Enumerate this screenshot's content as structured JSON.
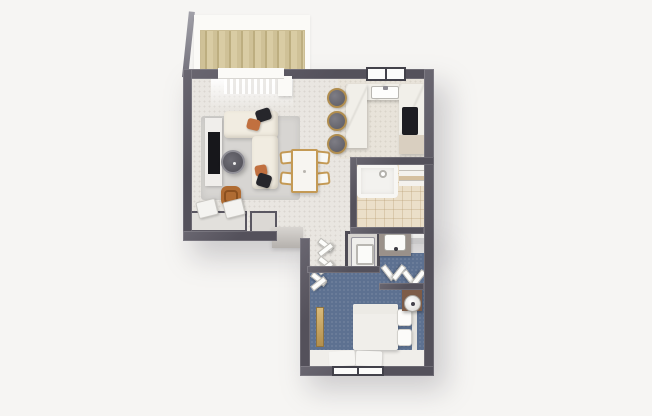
{
  "scene": {
    "kind": "3d-rendered-floor-plan",
    "view": "top-down",
    "text_labels": []
  },
  "palette": {
    "bg": "#f6f5f3",
    "wall": "#54515b",
    "white": "#fbfaf7",
    "floor_main": "#e9e6e1",
    "floor_kitchen": "#e8e3da",
    "tile": "#ebdfc9",
    "carpet_blue": "#5d7191",
    "rug_gray": "#d7d5d2",
    "sofa_cream": "#f1ece1",
    "pillow_black": "#26262b",
    "pillow_terracotta": "#c1703f",
    "chair_cognac": "#b06c33",
    "gold": "#c49a55",
    "tv_black": "#17171b",
    "marble": "#f1efe9",
    "cooktop_black": "#1d1d22",
    "cabinet_beige": "#d9cfc0",
    "nightstand_brown": "#7d5c48",
    "bed_white": "#f0eeea",
    "appliance_white": "#f0efec",
    "vanity_gray": "#9a918a"
  },
  "rooms": [
    {
      "id": "balcony",
      "name": "Balcony with wood deck"
    },
    {
      "id": "living-room",
      "name": "Living room"
    },
    {
      "id": "dining-area",
      "name": "Dining area"
    },
    {
      "id": "kitchen",
      "name": "Kitchen"
    },
    {
      "id": "bathroom",
      "name": "Bathroom"
    },
    {
      "id": "hallway",
      "name": "Hallway"
    },
    {
      "id": "laundry-wc",
      "name": "Laundry / WC niche"
    },
    {
      "id": "dressing-area",
      "name": "Dressing area"
    },
    {
      "id": "bedroom",
      "name": "Bedroom"
    }
  ],
  "furniture": {
    "balcony": [
      "wood deck",
      "white railing"
    ],
    "living": [
      "gray area rug",
      "L-shaped cream sectional sofa",
      "black throw pillow",
      "terracotta throw pillow",
      "round coffee table",
      "TV console",
      "flat-screen TV",
      "cognac accent chair",
      "desk with two white chairs",
      "sideboard",
      "window with sheer curtain"
    ],
    "dining": [
      "white dining table with gold legs",
      "four gold-frame dining chairs"
    ],
    "kitchen": [
      "U-shaped marble counter",
      "kitchen sink",
      "black cooktop",
      "three bar stools",
      "framed window",
      "lower cabinet"
    ],
    "bathroom": [
      "bathtub",
      "shower head",
      "shelf unit with towels",
      "beige tile floor"
    ],
    "hallway": [
      "open closet doors"
    ],
    "laundry_wc": [
      "white washer"
    ],
    "dressing": [
      "vanity counter with sink",
      "bifold closet doors"
    ],
    "bedroom": [
      "double bed with white duvet",
      "two pillows",
      "brown nightstand",
      "round table lamp",
      "gold floor mirror",
      "two white bedside rugs",
      "window"
    ]
  }
}
